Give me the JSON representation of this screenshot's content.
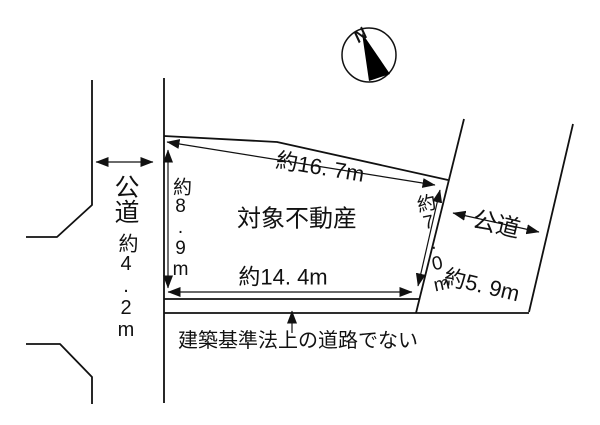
{
  "figure": {
    "background": "#ffffff",
    "line_color": "#111111",
    "needle_color": "#000000",
    "compass": {
      "label": "N"
    },
    "property": {
      "label": "対象不動産"
    },
    "left_road": {
      "name": "公道",
      "width": "約4.2m"
    },
    "right_road": {
      "name": "公道",
      "width": "約5. 9m"
    },
    "edges": {
      "top": "約16. 7m",
      "left": "約8.9m",
      "right": "約7.0m",
      "bottom": "約14. 4m"
    },
    "note": "建築基準法上の道路でない"
  }
}
